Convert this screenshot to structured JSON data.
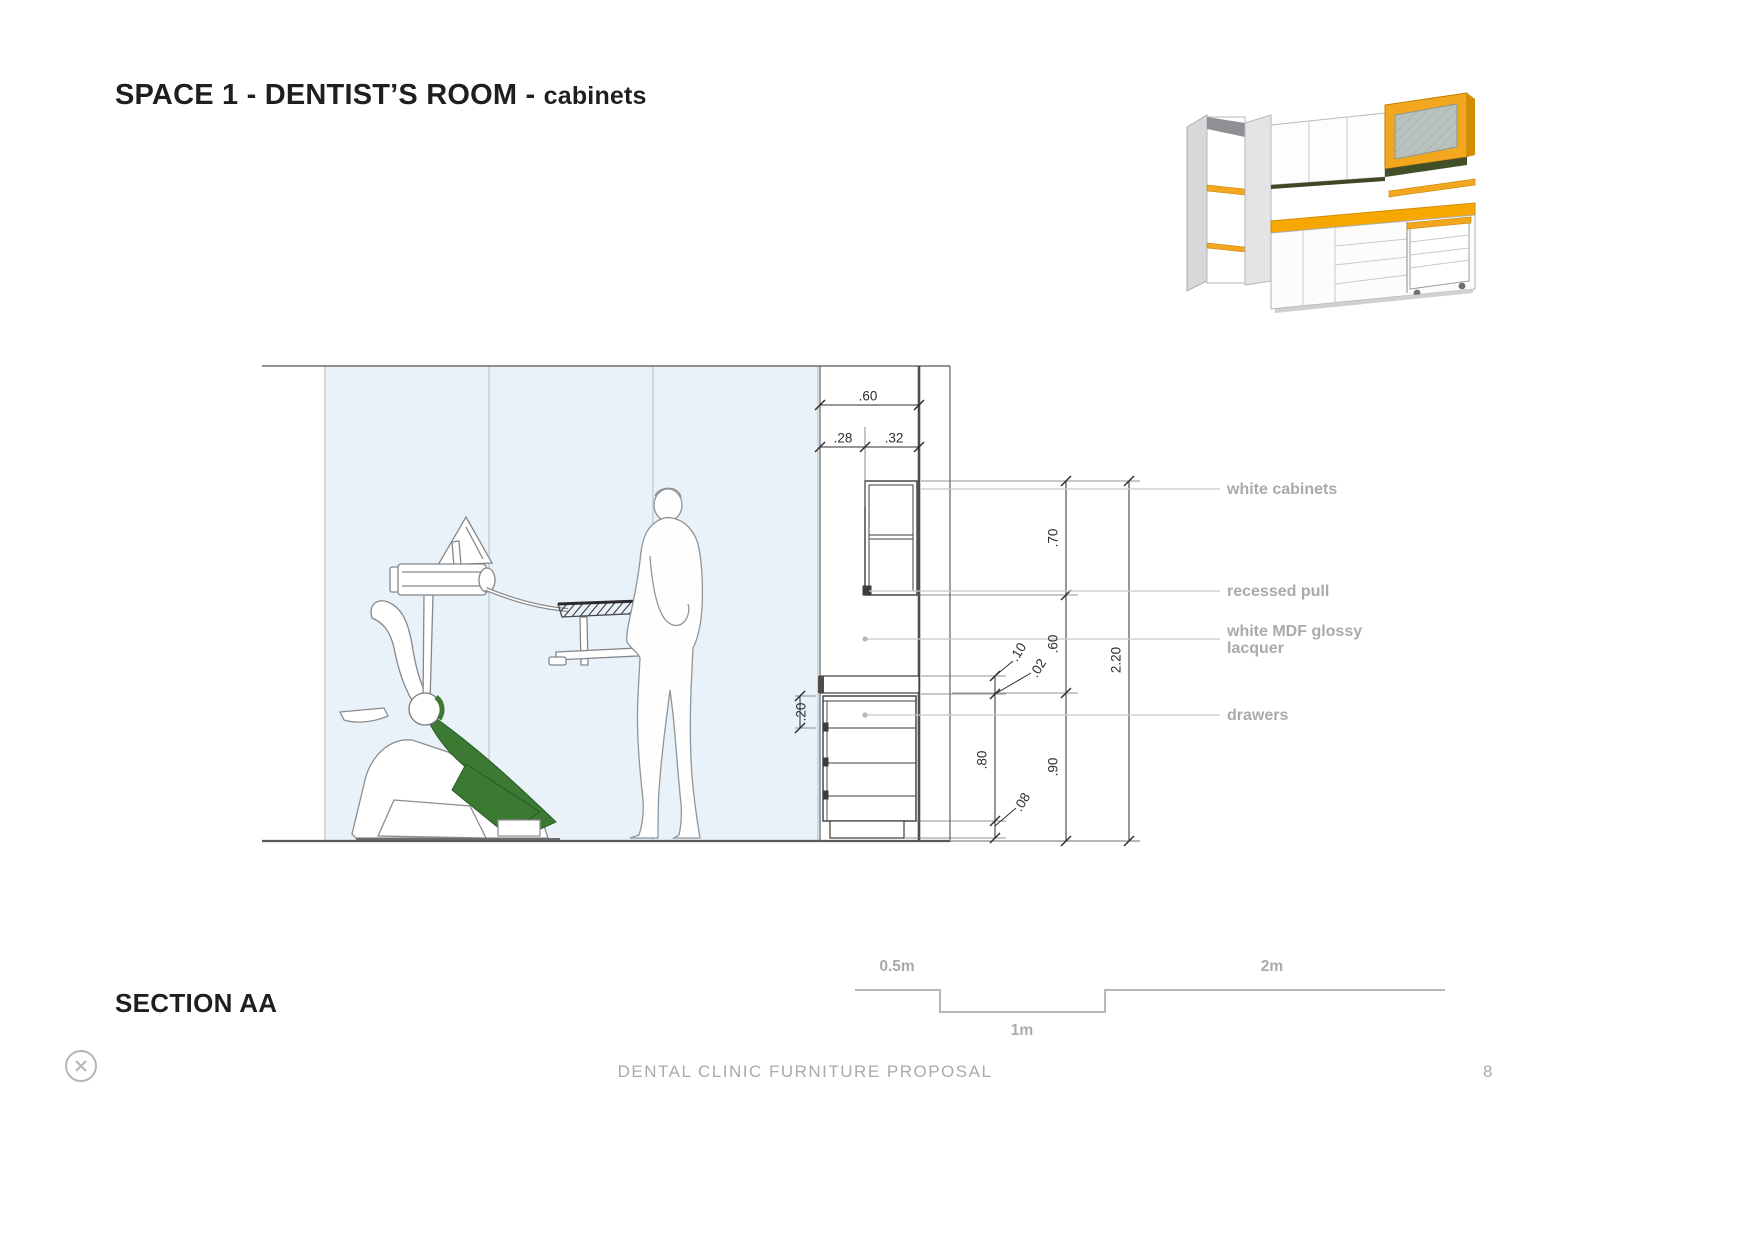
{
  "page": {
    "title_main": "SPACE 1 - DENTIST’S ROOM - ",
    "title_sub": "cabinets",
    "section_label": "SECTION AA",
    "footer_text": "DENTAL CLINIC FURNITURE PROPOSAL",
    "page_number": "8"
  },
  "annotations": {
    "white_cabinets": "white cabinets",
    "recessed_pull": "recessed pull",
    "mdf_line1": "white MDF glossy",
    "mdf_line2": "lacquer",
    "drawers": "drawers"
  },
  "dimensions": {
    "top_total": ".60",
    "top_left": ".28",
    "top_right": ".32",
    "upper_cabinet_height": ".70",
    "mid_open_height": ".60",
    "base_height": ".90",
    "total_height": "2.20",
    "counter_thickness": ".10",
    "counter_lip": ".02",
    "drawer_stack": ".80",
    "plinth": ".08",
    "top_drawer": ".20"
  },
  "scale_bar": {
    "half_m": "0.5m",
    "one_m": "1m",
    "two_m": "2m"
  },
  "colors": {
    "accent_yellow": "#F6A800",
    "accent_green": "#3C7A33",
    "glass_blue": "#E9F2F9",
    "label_gray": "#A8AAAD",
    "line_dark": "#2E2E30"
  }
}
